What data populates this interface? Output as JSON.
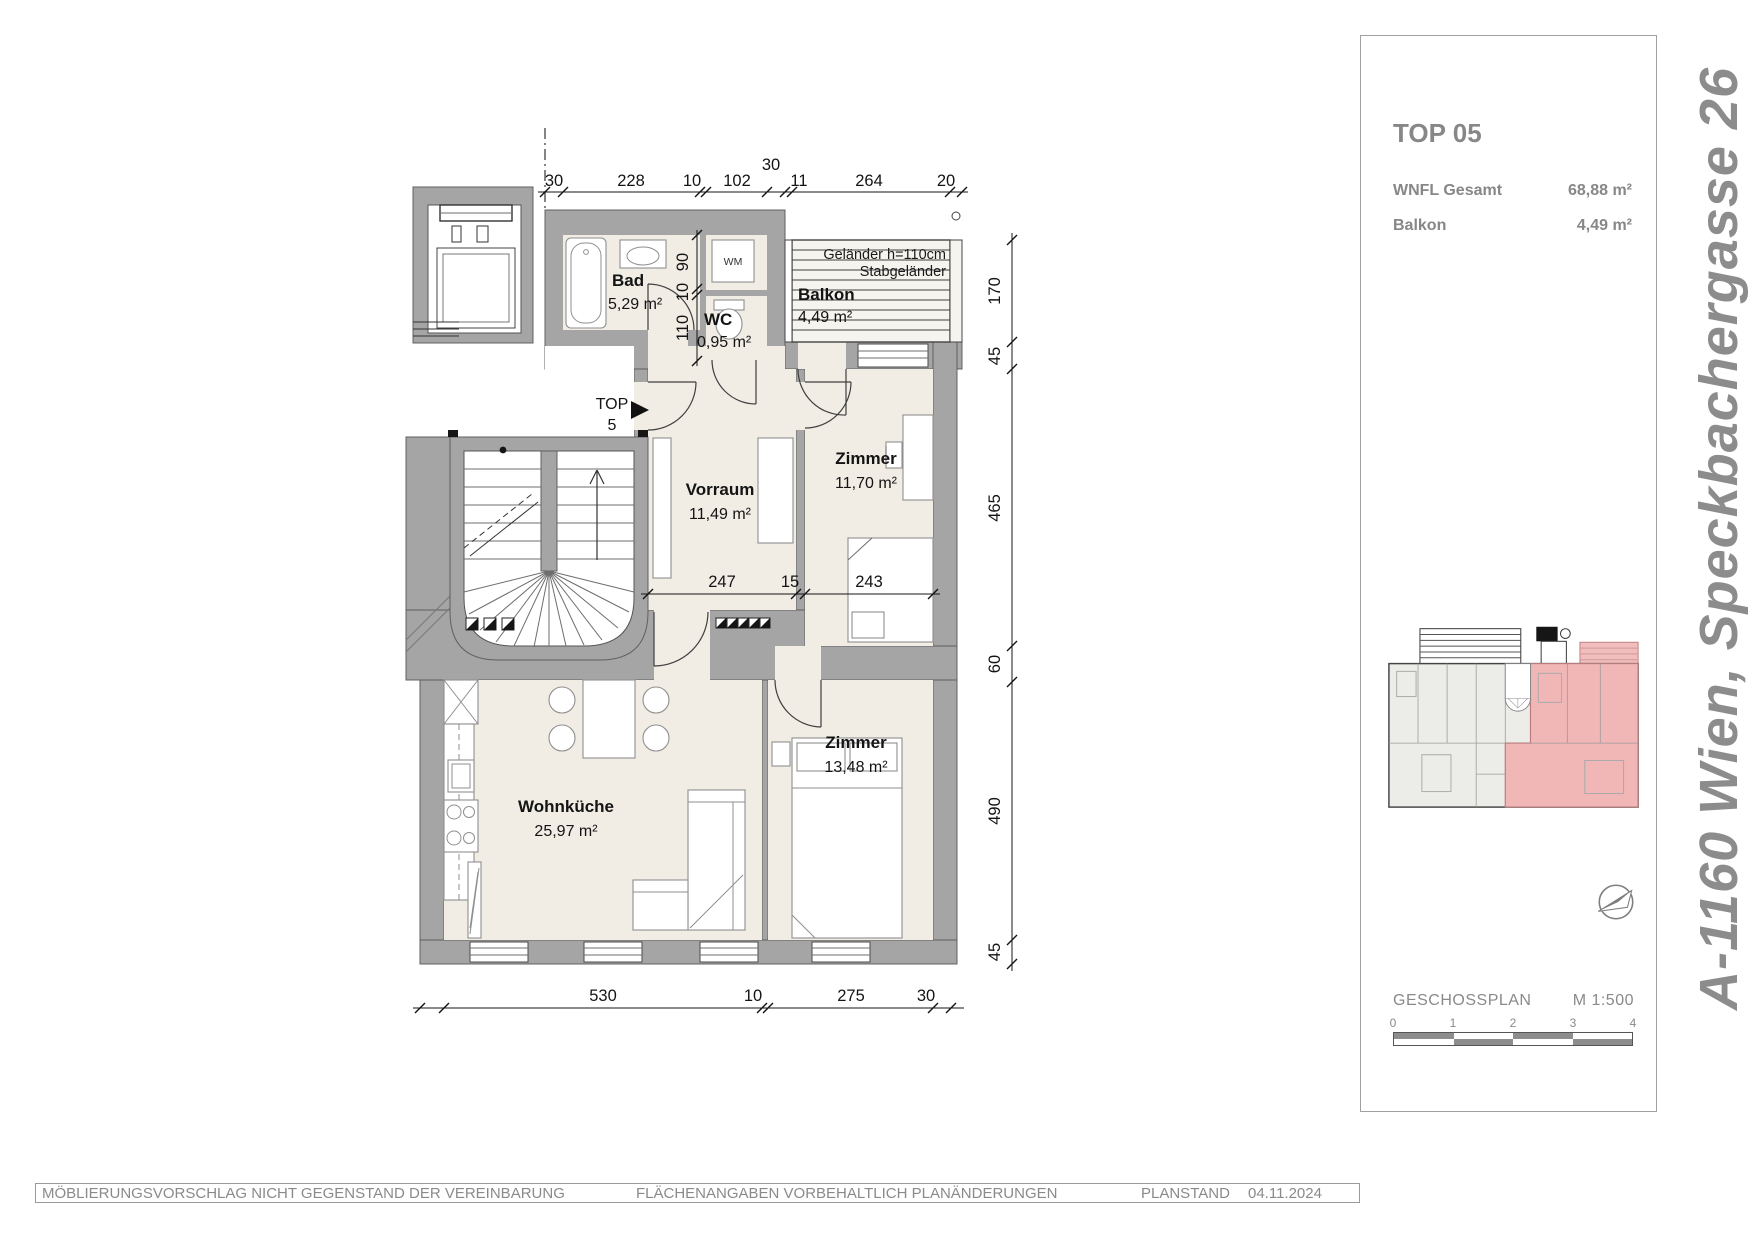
{
  "plan": {
    "rooms": [
      {
        "name": "Bad",
        "area": "5,29 m²"
      },
      {
        "name": "WC",
        "area": "0,95 m²"
      },
      {
        "name": "Balkon",
        "area": "4,49 m²"
      },
      {
        "name": "Vorraum",
        "area": "11,49 m²"
      },
      {
        "name": "Zimmer",
        "area": "11,70 m²"
      },
      {
        "name": "Wohnküche",
        "area": "25,97 m²"
      },
      {
        "name": "Zimmer",
        "area": "13,48 m²"
      }
    ],
    "labels": {
      "wm": "WM",
      "top_marker": "TOP",
      "top_marker_number": "5",
      "railing_line1": "Geländer h=110cm",
      "railing_line2": "Stabgeländer"
    },
    "dimensions": {
      "top": [
        "30",
        "228",
        "10",
        "102",
        "30",
        "11",
        "264",
        "20"
      ],
      "bad_internal": [
        "90",
        "10",
        "110"
      ],
      "middle": [
        "247",
        "15",
        "243"
      ],
      "right": [
        "170",
        "45",
        "465",
        "60",
        "490",
        "45"
      ],
      "bottom": [
        "530",
        "10",
        "275",
        "30"
      ]
    }
  },
  "sidebar": {
    "unit_title": "TOP 05",
    "stats": [
      {
        "label": "WNFL Gesamt",
        "value": "68,88 m²"
      },
      {
        "label": "Balkon",
        "value": "4,49 m²"
      }
    ],
    "plan_type": "GESCHOSSPLAN",
    "scale_label": "M 1:500",
    "scale_ticks": [
      "0",
      "1",
      "2",
      "3",
      "4"
    ]
  },
  "address": "A-1160 Wien, Speckbachergasse 26",
  "footer": {
    "disclaimer1": "MÖBLIERUNGSVORSCHLAG NICHT GEGENSTAND DER VEREINBARUNG",
    "disclaimer2": "FLÄCHENANGABEN VORBEHALTLICH PLANÄNDERUNGEN",
    "planstand_label": "PLANSTAND",
    "planstand_date": "04.11.2024"
  },
  "colors": {
    "wall_gray": "#a5a5a5",
    "floor_beige": "#f1ede5",
    "highlight_pink": "#f1b6b6",
    "text_gray": "#8a8a8a"
  }
}
